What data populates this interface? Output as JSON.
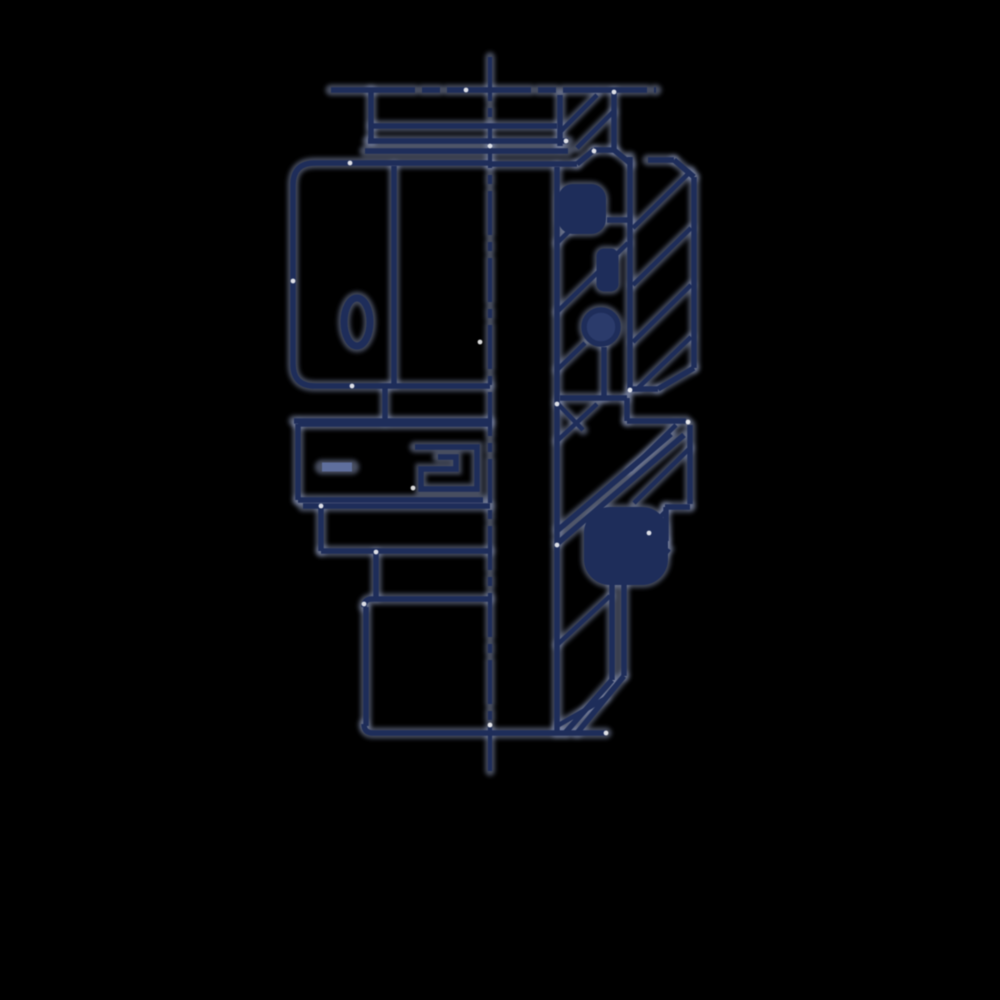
{
  "meta": {
    "title": "Hydraulic fitting half-section technical drawing",
    "description": "CAD line drawing of a tube fitting: left half outside view with hex nut, right half cross-section with hatching, o-ring seals and dash-dot centerline",
    "background_color": "#000000"
  },
  "drawing": {
    "canvas": {
      "width": 1000,
      "height": 1000
    },
    "colors": {
      "background": "#000000",
      "line": "#1e2d5a",
      "fill": "#2b3b6b",
      "halo": "#8f9cc0",
      "dash_mark": "#5f6f9d",
      "glint": "#ffffff"
    },
    "stroke": {
      "main": 5.5,
      "hatch": 4.5,
      "thin": 4.2,
      "halo_extra": 5.5,
      "halo_opacity": 0.5
    },
    "elements": [
      {
        "t": "line",
        "x1": 490,
        "y1": 57,
        "x2": 490,
        "y2": 777,
        "w": 4.2,
        "dash": "44 7 9 7",
        "name": "centerline"
      },
      {
        "t": "line",
        "x1": 331,
        "y1": 90,
        "x2": 656,
        "y2": 90,
        "dash": "84 7 18 7",
        "name": "phantom-top-line"
      },
      {
        "t": "line",
        "x1": 371,
        "y1": 90,
        "x2": 371,
        "y2": 141,
        "name": "top-stub-left"
      },
      {
        "t": "line",
        "x1": 372,
        "y1": 126,
        "x2": 557,
        "y2": 126,
        "name": "top-collar-upper"
      },
      {
        "t": "line",
        "x1": 368,
        "y1": 141,
        "x2": 568,
        "y2": 141,
        "name": "collar-line-1"
      },
      {
        "t": "line",
        "x1": 365,
        "y1": 151,
        "x2": 568,
        "y2": 151,
        "name": "collar-line-2"
      },
      {
        "t": "path",
        "d": "M490,163 H315 Q293,163 293,185 V364 Q293,386 315,386 H490",
        "name": "hex-nut-outline"
      },
      {
        "t": "line",
        "x1": 394,
        "y1": 166,
        "x2": 394,
        "y2": 384,
        "name": "hex-facet-line"
      },
      {
        "t": "ellipse",
        "cx": 357,
        "cy": 322,
        "rx": 13,
        "ry": 24,
        "w": 7,
        "name": "hex-oval-mark"
      },
      {
        "t": "line",
        "x1": 385,
        "y1": 388,
        "x2": 385,
        "y2": 421,
        "name": "stub-below-hex"
      },
      {
        "t": "line",
        "x1": 294,
        "y1": 421,
        "x2": 490,
        "y2": 421,
        "name": "mid-top-line-a"
      },
      {
        "t": "line",
        "x1": 298,
        "y1": 424,
        "x2": 490,
        "y2": 424,
        "name": "mid-top-line-b"
      },
      {
        "t": "line",
        "x1": 298,
        "y1": 424,
        "x2": 298,
        "y2": 500,
        "name": "mid-block-left"
      },
      {
        "t": "line",
        "x1": 298,
        "y1": 500,
        "x2": 483,
        "y2": 500,
        "name": "mid-block-bottom"
      },
      {
        "t": "line",
        "x1": 322,
        "y1": 467,
        "x2": 352,
        "y2": 467,
        "w": 9,
        "c": "dash_mark",
        "name": "mid-dash-mark"
      },
      {
        "t": "path",
        "d": "M415,447 H477 V489 H421 V469 H456 V457 H438",
        "name": "spiral-glyph"
      },
      {
        "t": "line",
        "x1": 303,
        "y1": 506,
        "x2": 490,
        "y2": 506,
        "name": "plate-top"
      },
      {
        "t": "line",
        "x1": 321,
        "y1": 506,
        "x2": 321,
        "y2": 551,
        "name": "plate-left"
      },
      {
        "t": "line",
        "x1": 321,
        "y1": 551,
        "x2": 490,
        "y2": 551,
        "name": "plate-bottom"
      },
      {
        "t": "line",
        "x1": 376,
        "y1": 553,
        "x2": 376,
        "y2": 597,
        "name": "neck-left"
      },
      {
        "t": "path",
        "d": "M490,599 H372 Q364,599 364,607",
        "name": "stem-top"
      },
      {
        "t": "line",
        "x1": 366,
        "y1": 607,
        "x2": 366,
        "y2": 726,
        "name": "stem-left"
      },
      {
        "t": "path",
        "d": "M364,724 Q364,733 373,733 H606",
        "name": "bottom-edge"
      },
      {
        "t": "line",
        "x1": 560,
        "y1": 95,
        "x2": 560,
        "y2": 146,
        "name": "bore-wall-top"
      },
      {
        "t": "line",
        "x1": 557,
        "y1": 167,
        "x2": 557,
        "y2": 733,
        "name": "bore-wall"
      },
      {
        "t": "line",
        "x1": 614,
        "y1": 92,
        "x2": 614,
        "y2": 150,
        "name": "locknut-right"
      },
      {
        "t": "line",
        "x1": 614,
        "y1": 150,
        "x2": 631,
        "y2": 164,
        "name": "locknut-chamfer"
      },
      {
        "t": "line",
        "x1": 561,
        "y1": 131,
        "x2": 597,
        "y2": 95,
        "w": 4.5,
        "name": "hatch-top-1"
      },
      {
        "t": "line",
        "x1": 577,
        "y1": 148,
        "x2": 613,
        "y2": 112,
        "w": 4.5,
        "name": "hatch-top-2"
      },
      {
        "t": "line",
        "x1": 490,
        "y1": 164,
        "x2": 577,
        "y2": 164,
        "name": "body-top-face"
      },
      {
        "t": "line",
        "x1": 577,
        "y1": 164,
        "x2": 594,
        "y2": 150,
        "name": "body-top-chamfer"
      },
      {
        "t": "line",
        "x1": 594,
        "y1": 150,
        "x2": 614,
        "y2": 150,
        "name": "body-top-short"
      },
      {
        "t": "line",
        "x1": 630,
        "y1": 157,
        "x2": 630,
        "y2": 390,
        "name": "thread-block-left"
      },
      {
        "t": "line",
        "x1": 648,
        "y1": 160,
        "x2": 674,
        "y2": 160,
        "name": "thread-block-top"
      },
      {
        "t": "line",
        "x1": 674,
        "y1": 160,
        "x2": 694,
        "y2": 177,
        "name": "thread-block-chamfer-tr"
      },
      {
        "t": "line",
        "x1": 694,
        "y1": 177,
        "x2": 694,
        "y2": 368,
        "name": "thread-block-right"
      },
      {
        "t": "line",
        "x1": 694,
        "y1": 368,
        "x2": 658,
        "y2": 389,
        "name": "thread-block-chamfer-br"
      },
      {
        "t": "line",
        "x1": 630,
        "y1": 389,
        "x2": 658,
        "y2": 389,
        "name": "thread-block-bottom"
      },
      {
        "t": "line",
        "x1": 633,
        "y1": 228,
        "x2": 691,
        "y2": 171,
        "w": 4.5,
        "name": "hatch-block1-1"
      },
      {
        "t": "line",
        "x1": 633,
        "y1": 285,
        "x2": 691,
        "y2": 228,
        "w": 4.5,
        "name": "hatch-block1-2"
      },
      {
        "t": "line",
        "x1": 633,
        "y1": 342,
        "x2": 691,
        "y2": 285,
        "w": 4.5,
        "name": "hatch-block1-3"
      },
      {
        "t": "line",
        "x1": 637,
        "y1": 389,
        "x2": 691,
        "y2": 337,
        "w": 4.5,
        "name": "hatch-block1-4"
      },
      {
        "t": "rect",
        "x": 570,
        "y": 196,
        "w": 24,
        "h": 26,
        "r": 3,
        "name": "seal-square-top"
      },
      {
        "t": "line",
        "x1": 557,
        "y1": 243,
        "x2": 600,
        "y2": 201,
        "w": 4.5,
        "name": "thread-diag-1"
      },
      {
        "t": "line",
        "x1": 607,
        "y1": 220,
        "x2": 630,
        "y2": 220,
        "name": "seal-seat-line"
      },
      {
        "t": "rect",
        "x": 602,
        "y": 254,
        "w": 11,
        "h": 32,
        "r": 2,
        "name": "seal-bar"
      },
      {
        "t": "line",
        "x1": 557,
        "y1": 312,
        "x2": 628,
        "y2": 243,
        "w": 4.5,
        "name": "thread-diag-2"
      },
      {
        "t": "circle",
        "cx": 601,
        "cy": 327,
        "r": 17,
        "name": "o-ring-section"
      },
      {
        "t": "line",
        "x1": 557,
        "y1": 370,
        "x2": 585,
        "y2": 343,
        "w": 4.5,
        "name": "thread-diag-3"
      },
      {
        "t": "line",
        "x1": 604,
        "y1": 347,
        "x2": 604,
        "y2": 398,
        "name": "bore-step-v"
      },
      {
        "t": "line",
        "x1": 560,
        "y1": 398,
        "x2": 627,
        "y2": 398,
        "name": "bore-step-h"
      },
      {
        "t": "line",
        "x1": 627,
        "y1": 398,
        "x2": 627,
        "y2": 421,
        "name": "step-riser"
      },
      {
        "t": "line",
        "x1": 627,
        "y1": 421,
        "x2": 686,
        "y2": 421,
        "name": "step-block-top"
      },
      {
        "t": "line",
        "x1": 557,
        "y1": 403,
        "x2": 583,
        "y2": 430,
        "w": 4.5,
        "name": "cone-diag-a"
      },
      {
        "t": "line",
        "x1": 557,
        "y1": 441,
        "x2": 597,
        "y2": 404,
        "w": 4.5,
        "name": "cone-diag-b"
      },
      {
        "t": "line",
        "x1": 558,
        "y1": 543,
        "x2": 684,
        "y2": 435,
        "name": "cone-edge-1"
      },
      {
        "t": "line",
        "x1": 558,
        "y1": 530,
        "x2": 671,
        "y2": 434,
        "name": "cone-edge-2"
      },
      {
        "t": "line",
        "x1": 690,
        "y1": 425,
        "x2": 690,
        "y2": 504,
        "name": "step-block-right"
      },
      {
        "t": "line",
        "x1": 665,
        "y1": 507,
        "x2": 690,
        "y2": 507,
        "name": "step-shoulder-h"
      },
      {
        "t": "line",
        "x1": 666,
        "y1": 507,
        "x2": 666,
        "y2": 541,
        "name": "step-shoulder-v"
      },
      {
        "t": "line",
        "x1": 666,
        "y1": 541,
        "x2": 652,
        "y2": 557,
        "name": "step-shoulder-diag"
      },
      {
        "t": "line",
        "x1": 634,
        "y1": 503,
        "x2": 690,
        "y2": 448,
        "w": 4.5,
        "name": "hatch-block2-1"
      },
      {
        "t": "line",
        "x1": 630,
        "y1": 470,
        "x2": 676,
        "y2": 425,
        "w": 4.5,
        "name": "hatch-block2-2"
      },
      {
        "t": "rect",
        "x": 605,
        "y": 528,
        "w": 42,
        "h": 36,
        "r": 5,
        "name": "seal-square-bottom"
      },
      {
        "t": "line",
        "x1": 647,
        "y1": 531,
        "x2": 665,
        "y2": 512,
        "w": 4.5,
        "name": "seal-diag-1"
      },
      {
        "t": "line",
        "x1": 600,
        "y1": 566,
        "x2": 656,
        "y2": 566,
        "name": "seal-base-h"
      },
      {
        "t": "line",
        "x1": 656,
        "y1": 566,
        "x2": 669,
        "y2": 549,
        "w": 4.5,
        "name": "seal-diag-2"
      },
      {
        "t": "line",
        "x1": 612,
        "y1": 572,
        "x2": 612,
        "y2": 680,
        "name": "tube-wall-inner"
      },
      {
        "t": "line",
        "x1": 624,
        "y1": 572,
        "x2": 624,
        "y2": 676,
        "name": "tube-wall-outer"
      },
      {
        "t": "line",
        "x1": 612,
        "y1": 680,
        "x2": 565,
        "y2": 733,
        "name": "tube-chamfer-1"
      },
      {
        "t": "line",
        "x1": 624,
        "y1": 676,
        "x2": 577,
        "y2": 733,
        "name": "tube-chamfer-2"
      },
      {
        "t": "line",
        "x1": 557,
        "y1": 645,
        "x2": 610,
        "y2": 596,
        "w": 4.5,
        "name": "hatch-tube-1"
      },
      {
        "t": "line",
        "x1": 557,
        "y1": 726,
        "x2": 606,
        "y2": 698,
        "w": 4.5,
        "name": "hatch-tube-2"
      }
    ],
    "glints": [
      {
        "x": 350,
        "y": 163
      },
      {
        "x": 293,
        "y": 281
      },
      {
        "x": 352,
        "y": 386
      },
      {
        "x": 466,
        "y": 90
      },
      {
        "x": 490,
        "y": 146
      },
      {
        "x": 557,
        "y": 545
      },
      {
        "x": 594,
        "y": 151
      },
      {
        "x": 614,
        "y": 92
      },
      {
        "x": 321,
        "y": 506
      },
      {
        "x": 364,
        "y": 604
      },
      {
        "x": 606,
        "y": 733
      },
      {
        "x": 688,
        "y": 422
      },
      {
        "x": 480,
        "y": 342
      },
      {
        "x": 413,
        "y": 488
      },
      {
        "x": 376,
        "y": 552
      },
      {
        "x": 630,
        "y": 390
      },
      {
        "x": 557,
        "y": 404
      },
      {
        "x": 649,
        "y": 533
      },
      {
        "x": 490,
        "y": 725
      },
      {
        "x": 566,
        "y": 141
      }
    ]
  }
}
